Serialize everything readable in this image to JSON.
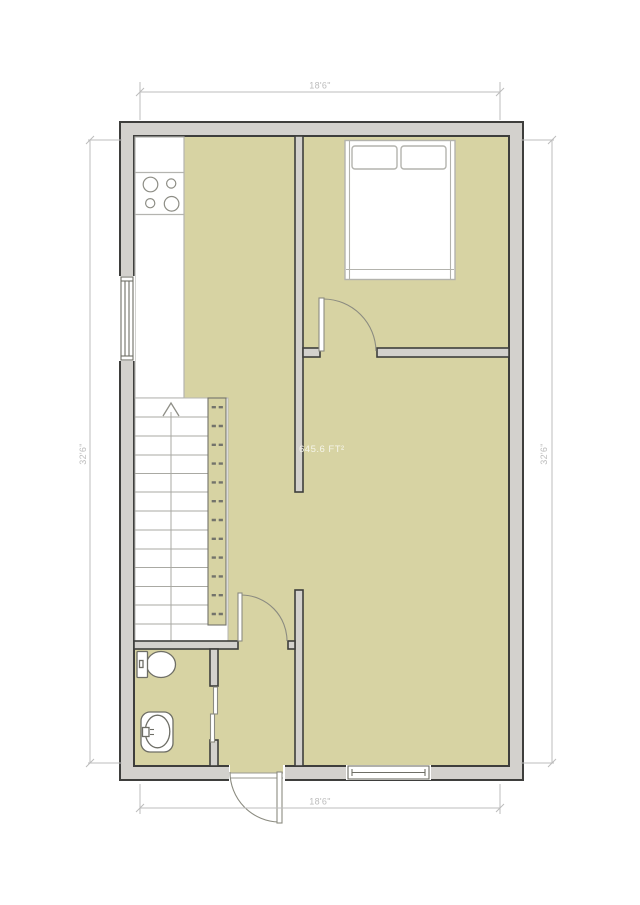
{
  "labels": {
    "width_top": "18'6\"",
    "width_bottom": "18'6\"",
    "height_left": "32'6\"",
    "height_right": "32'6\"",
    "area": "645.6 FT²"
  },
  "palette": {
    "floor_fill": "#d7d3a3",
    "wall_fill": "#d3d1cd",
    "wall_outline": "#3e3e3c",
    "counter_outline": "#b4b4b0",
    "stair_line": "#a9a9a3",
    "rail_outline": "#73736b",
    "fixture_outline": "#6e6e66",
    "furniture_outline": "#b3b3ad",
    "door_line": "#8b8b80",
    "dim_color": "#bcbcbc",
    "area_text_color": "#f8f8f0"
  },
  "icons": {
    "stove_cooktop_icon": "four burner circles",
    "bed_icon": "double bed with two pillows",
    "stairs_up_icon": "staircase with up arrow",
    "toilet_icon": "toilet tank and bowl",
    "sink_icon": "oval basin with faucet",
    "window_icon": "double-line window in wall",
    "door_icon": "door leaf with quarter-circle swing"
  }
}
